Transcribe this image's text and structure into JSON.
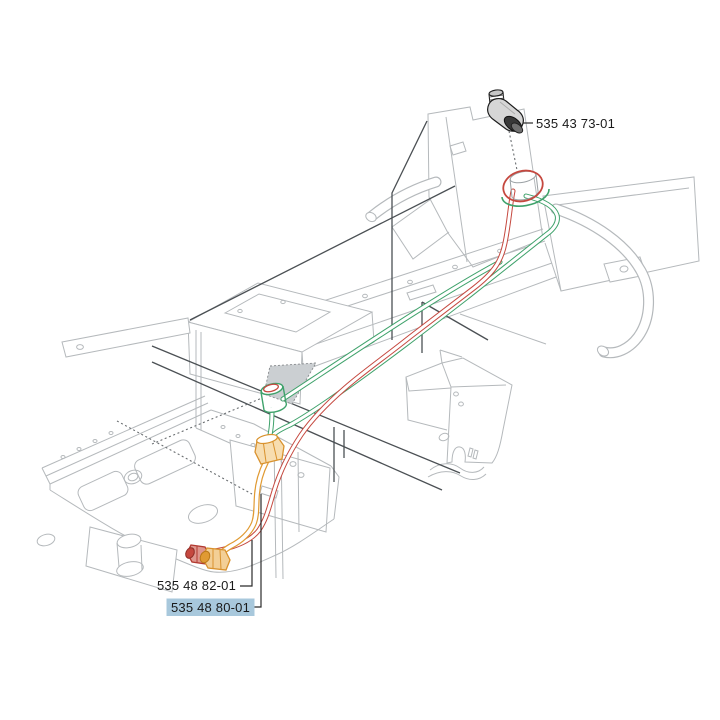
{
  "page": {
    "background": "#ffffff",
    "kind": "exploded-parts-diagram",
    "subject": "frame with fuel lines and fittings"
  },
  "callouts": {
    "elbow_fitting": {
      "part_number": "535 43 73-01",
      "highlighted": false
    },
    "fuel_hose_red": {
      "part_number": "535 48 82-01",
      "highlighted": false
    },
    "fuel_pipe_orange": {
      "part_number": "535 48 80-01",
      "highlighted": true
    }
  },
  "selected_part": "535 48 80-01",
  "colors": {
    "hose_red": "#c5483f",
    "hose_green": "#3fa26b",
    "fuel_pipe_orange": "#e09a33",
    "orange_fill": "#f6d9a8",
    "red_fill": "#df968d",
    "selection_highlight": "#a8c8dc",
    "frame_line": "#b5b9bc",
    "dark_line": "#4b5054",
    "label_text": "#1a1a1a"
  }
}
